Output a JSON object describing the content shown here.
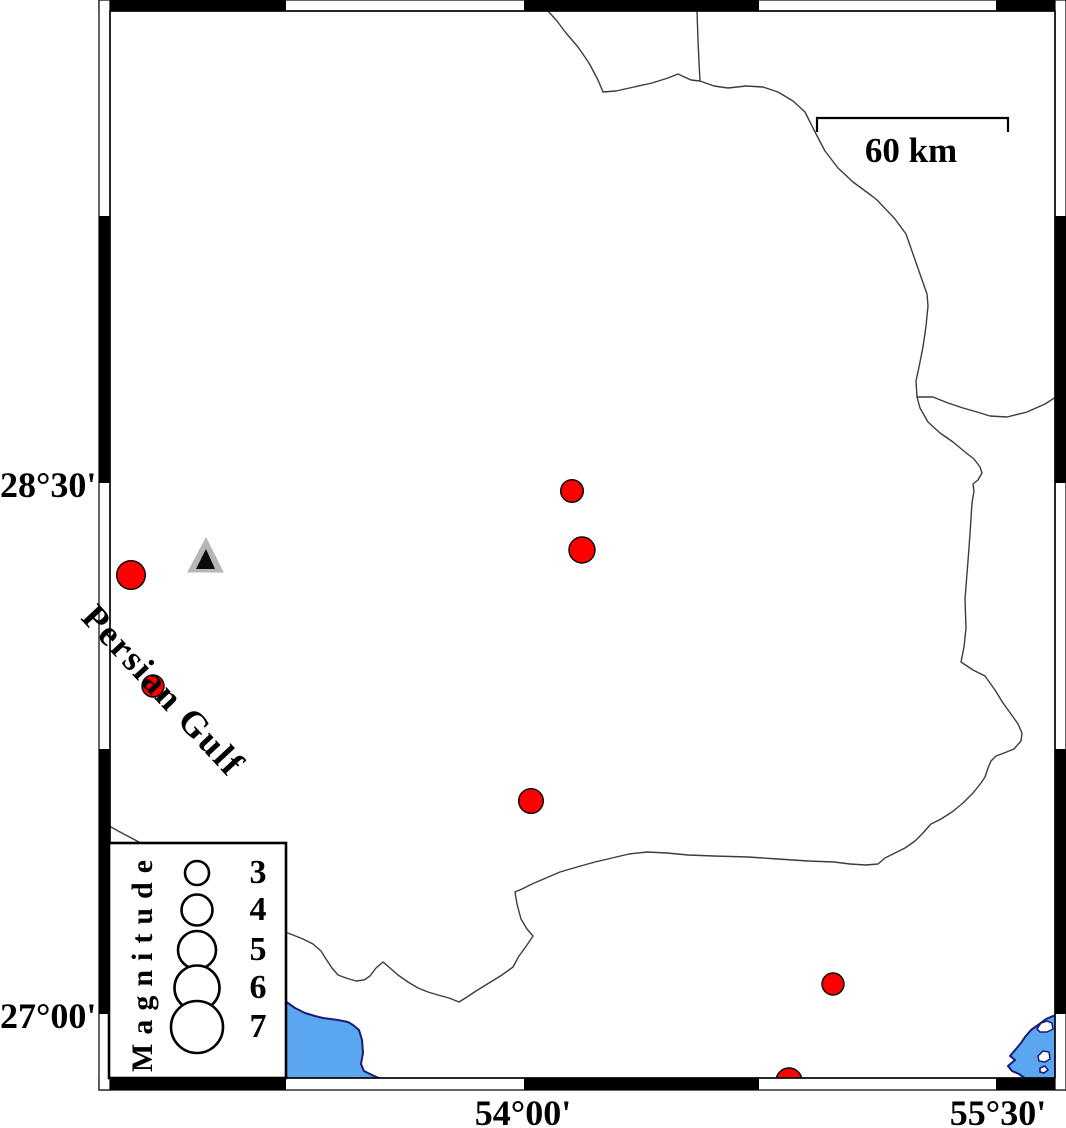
{
  "figure": {
    "width": 1066,
    "height": 1128,
    "background": "#ffffff"
  },
  "frame": {
    "outer": {
      "x": 99,
      "y": 0,
      "w": 967,
      "h": 1090
    },
    "inner": {
      "x": 110,
      "y": 11,
      "w": 945,
      "h": 1067
    },
    "bar_thickness": 11,
    "horizontal_black_segments": [
      [
        110,
        286
      ],
      [
        524,
        759
      ],
      [
        996,
        1055
      ]
    ],
    "vertical_black_segments": [
      [
        216,
        483
      ],
      [
        749,
        1014
      ]
    ]
  },
  "axis_labels": {
    "left": [
      {
        "text": "28°30'",
        "y": 485
      },
      {
        "text": "27°00'",
        "y": 1016
      }
    ],
    "bottom": [
      {
        "text": "54°00'",
        "x": 523
      },
      {
        "text": "55°30'",
        "x": 998
      }
    ]
  },
  "scale_bar": {
    "label": "60 km",
    "x1": 817,
    "x2": 1008,
    "y": 118,
    "tick": 14
  },
  "sea_label": {
    "text": "Persian Gulf",
    "angle_deg": 47
  },
  "legend": {
    "title": "Magnitude",
    "box": {
      "x": 109,
      "y": 843,
      "w": 177,
      "h": 235
    },
    "circle_cx": 197,
    "entries": [
      {
        "label": "3",
        "cy": 873,
        "r": 12
      },
      {
        "label": "4",
        "cy": 910,
        "r": 15.5
      },
      {
        "label": "5",
        "cy": 950,
        "r": 19
      },
      {
        "label": "6",
        "cy": 988,
        "r": 22.5
      },
      {
        "label": "7",
        "cy": 1027,
        "r": 26
      }
    ]
  },
  "markers": {
    "earthquake_color": "#ff0000",
    "earthquake_outline": "#000000",
    "earthquakes": [
      {
        "x": 131,
        "y": 575,
        "r": 14.3
      },
      {
        "x": 153,
        "y": 686,
        "r": 11
      },
      {
        "x": 572,
        "y": 491,
        "r": 11.3
      },
      {
        "x": 582,
        "y": 550,
        "r": 13
      },
      {
        "x": 531,
        "y": 801,
        "r": 12.3
      },
      {
        "x": 833,
        "y": 984,
        "r": 11
      },
      {
        "x": 789,
        "y": 1081,
        "r": 13
      }
    ],
    "station": {
      "outer_fill": "#b6b6b6",
      "inner_fill": "#0a0a0a",
      "outer": [
        [
          188,
          572
        ],
        [
          223,
          572
        ],
        [
          206,
          538
        ]
      ],
      "inner": [
        [
          196,
          569
        ],
        [
          215,
          569
        ],
        [
          206,
          549
        ]
      ]
    }
  },
  "boundaries": {
    "color": "#3c3c3c",
    "width": 1.4,
    "paths": [
      [
        [
          548,
          11
        ],
        [
          557,
          21
        ],
        [
          566,
          33
        ],
        [
          578,
          47
        ],
        [
          589,
          63
        ],
        [
          598,
          80
        ],
        [
          603,
          92
        ],
        [
          616,
          91
        ],
        [
          634,
          87
        ],
        [
          652,
          83
        ],
        [
          668,
          78
        ],
        [
          678,
          74
        ],
        [
          691,
          80
        ],
        [
          700,
          81
        ],
        [
          714,
          86
        ],
        [
          728,
          88
        ],
        [
          746,
          86
        ],
        [
          763,
          87
        ],
        [
          778,
          92
        ],
        [
          793,
          101
        ],
        [
          805,
          112
        ],
        [
          815,
          132
        ],
        [
          825,
          151
        ],
        [
          838,
          168
        ],
        [
          853,
          182
        ],
        [
          872,
          196
        ],
        [
          877,
          200
        ],
        [
          895,
          219
        ],
        [
          906,
          234
        ],
        [
          913,
          254
        ],
        [
          921,
          277
        ],
        [
          927,
          294
        ],
        [
          928,
          306
        ],
        [
          926,
          326
        ],
        [
          923,
          347
        ],
        [
          919,
          367
        ],
        [
          916,
          381
        ],
        [
          917,
          397
        ],
        [
          920,
          408
        ],
        [
          928,
          422
        ],
        [
          940,
          433
        ],
        [
          953,
          442
        ],
        [
          965,
          452
        ],
        [
          974,
          459
        ],
        [
          980,
          467
        ],
        [
          982,
          473
        ],
        [
          978,
          480
        ],
        [
          973,
          484
        ],
        [
          974,
          491
        ],
        [
          972,
          503
        ],
        [
          970,
          534
        ],
        [
          968,
          561
        ],
        [
          965,
          599
        ],
        [
          966,
          628
        ],
        [
          964,
          647
        ],
        [
          961,
          662
        ],
        [
          973,
          670
        ],
        [
          985,
          676
        ],
        [
          995,
          690
        ],
        [
          1003,
          703
        ],
        [
          1011,
          714
        ],
        [
          1018,
          724
        ],
        [
          1022,
          733
        ],
        [
          1021,
          741
        ],
        [
          1014,
          749
        ],
        [
          1004,
          753
        ],
        [
          996,
          756
        ],
        [
          991,
          761
        ],
        [
          988,
          768
        ],
        [
          985,
          777
        ],
        [
          981,
          783
        ],
        [
          973,
          793
        ],
        [
          963,
          803
        ],
        [
          952,
          812
        ],
        [
          941,
          819
        ],
        [
          931,
          824
        ],
        [
          923,
          833
        ],
        [
          915,
          841
        ],
        [
          905,
          848
        ],
        [
          895,
          853
        ],
        [
          885,
          858
        ],
        [
          878,
          864
        ],
        [
          866,
          865
        ],
        [
          850,
          864
        ],
        [
          834,
          862
        ],
        [
          808,
          861
        ],
        [
          778,
          859
        ],
        [
          748,
          857
        ],
        [
          714,
          856
        ],
        [
          688,
          855
        ],
        [
          667,
          853
        ],
        [
          647,
          852
        ],
        [
          629,
          854
        ],
        [
          612,
          858
        ],
        [
          595,
          862
        ],
        [
          577,
          867
        ],
        [
          560,
          872
        ],
        [
          546,
          878
        ],
        [
          532,
          884
        ],
        [
          522,
          889
        ],
        [
          515,
          892
        ],
        [
          517,
          904
        ],
        [
          521,
          919
        ],
        [
          527,
          929
        ],
        [
          533,
          936
        ],
        [
          527,
          945
        ],
        [
          519,
          956
        ],
        [
          513,
          967
        ],
        [
          502,
          975
        ],
        [
          489,
          983
        ],
        [
          476,
          991
        ],
        [
          467,
          997
        ],
        [
          459,
          1002
        ],
        [
          449,
          998
        ],
        [
          438,
          995
        ],
        [
          428,
          992
        ],
        [
          418,
          988
        ],
        [
          408,
          982
        ],
        [
          398,
          975
        ],
        [
          390,
          968
        ],
        [
          383,
          962
        ],
        [
          376,
          968
        ],
        [
          370,
          976
        ],
        [
          364,
          980
        ],
        [
          356,
          981
        ],
        [
          346,
          978
        ],
        [
          338,
          975
        ],
        [
          332,
          968
        ],
        [
          326,
          959
        ],
        [
          321,
          951
        ],
        [
          313,
          944
        ],
        [
          303,
          939
        ],
        [
          293,
          935
        ],
        [
          285,
          932
        ],
        [
          278,
          930
        ]
      ],
      [
        [
          697,
          11
        ],
        [
          698,
          40
        ],
        [
          699,
          62
        ],
        [
          700,
          81
        ]
      ],
      [
        [
          917,
          397
        ],
        [
          933,
          397
        ],
        [
          948,
          403
        ],
        [
          963,
          408
        ],
        [
          977,
          412
        ],
        [
          990,
          416
        ],
        [
          1007,
          417
        ],
        [
          1027,
          412
        ],
        [
          1045,
          404
        ],
        [
          1056,
          397
        ]
      ],
      [
        [
          102,
          822
        ],
        [
          120,
          832
        ],
        [
          137,
          841
        ],
        [
          152,
          850
        ]
      ]
    ]
  },
  "water": {
    "fill": "#5aa7f0",
    "stroke": "#1a1a78",
    "bodies": [
      {
        "points": [
          [
            285,
            1001
          ],
          [
            295,
            1008
          ],
          [
            305,
            1013
          ],
          [
            315,
            1016
          ],
          [
            323,
            1018
          ],
          [
            338,
            1020
          ],
          [
            348,
            1022
          ],
          [
            353,
            1025
          ],
          [
            359,
            1030
          ],
          [
            362,
            1040
          ],
          [
            363,
            1053
          ],
          [
            361,
            1064
          ],
          [
            364,
            1071
          ],
          [
            372,
            1075
          ],
          [
            381,
            1079
          ],
          [
            285,
            1079
          ]
        ]
      },
      {
        "points": [
          [
            1058,
            1014
          ],
          [
            1046,
            1019
          ],
          [
            1038,
            1025
          ],
          [
            1031,
            1030
          ],
          [
            1025,
            1037
          ],
          [
            1021,
            1043
          ],
          [
            1016,
            1049
          ],
          [
            1010,
            1056
          ],
          [
            1015,
            1060
          ],
          [
            1008,
            1066
          ],
          [
            1012,
            1071
          ],
          [
            1019,
            1074
          ],
          [
            1026,
            1079
          ],
          [
            1058,
            1079
          ]
        ],
        "islands": [
          [
            [
              1037,
              1029
            ],
            [
              1041,
              1023
            ],
            [
              1047,
              1021
            ],
            [
              1052,
              1023
            ],
            [
              1053,
              1029
            ],
            [
              1047,
              1032
            ],
            [
              1040,
              1032
            ]
          ],
          [
            [
              1038,
              1056
            ],
            [
              1043,
              1051
            ],
            [
              1049,
              1052
            ],
            [
              1050,
              1059
            ],
            [
              1045,
              1062
            ],
            [
              1039,
              1061
            ]
          ],
          [
            [
              1040,
              1068
            ],
            [
              1045,
              1066
            ],
            [
              1048,
              1070
            ],
            [
              1044,
              1073
            ],
            [
              1040,
              1072
            ]
          ]
        ]
      }
    ]
  }
}
